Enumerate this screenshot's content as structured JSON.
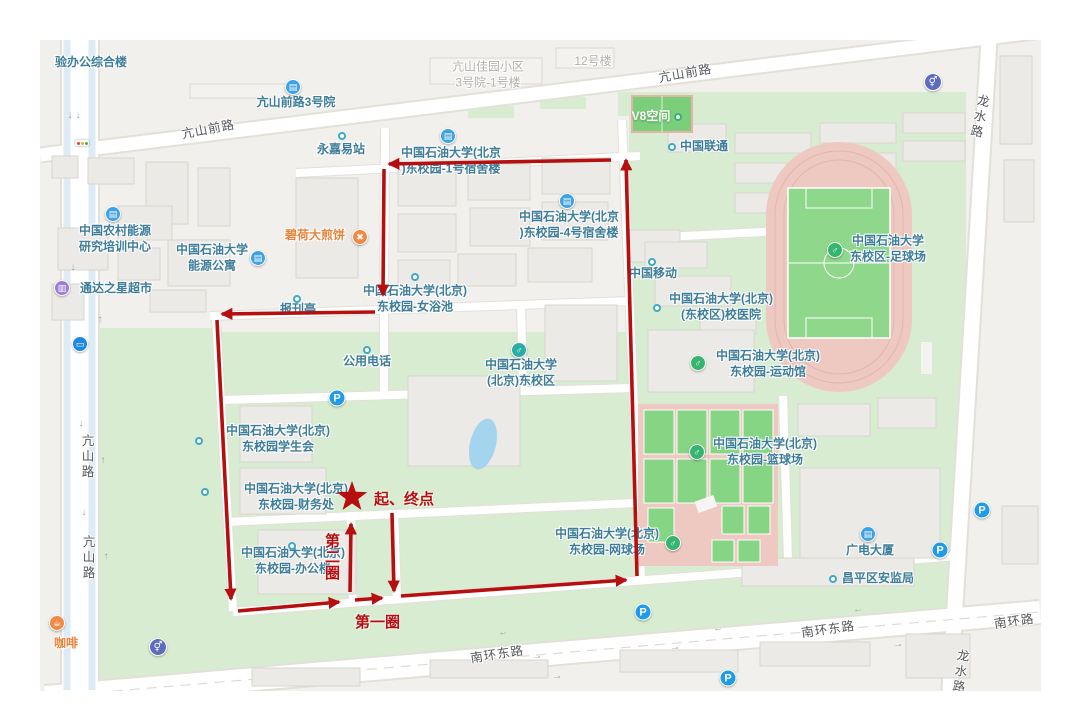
{
  "colors": {
    "map_bg": "#f1f0ed",
    "campus_green": "#d8ecd1",
    "track_pink": "#edc9c2",
    "pitch_green": "#8fd88b",
    "water_blue": "#a5d4ee",
    "poi_teal": "#3d7d99",
    "route_red": "#b60f0f"
  },
  "map": {
    "icons": {
      "building": "▤",
      "sport": "♂",
      "univ": "♂",
      "shop": "▥",
      "restaurant": "✖",
      "coffee": "☕",
      "parking": "P",
      "restroom": "⚥",
      "bus": "▭",
      "dot": "",
      "greendot": ""
    },
    "pois": [
      {
        "text": "验办公综合楼",
        "x": 91,
        "y": 63,
        "cls": "teal"
      },
      {
        "text": "亢山前路3号院",
        "x": 296,
        "y": 103,
        "cls": "teal",
        "icon": "building",
        "ix": 293,
        "iy": 87
      },
      {
        "text": "亢山佳园小区\n3号院-1号楼",
        "x": 488,
        "y": 75,
        "cls": "gray"
      },
      {
        "text": "12号楼",
        "x": 593,
        "y": 62,
        "cls": "gray"
      },
      {
        "text": "永嘉易站",
        "x": 341,
        "y": 150,
        "cls": "teal",
        "icon": "dot",
        "ix": 342,
        "iy": 136
      },
      {
        "text": "中国石油大学(北京\n)东校园-1号宿舍楼",
        "x": 451,
        "y": 161,
        "cls": "teal",
        "icon": "building",
        "ix": 448,
        "iy": 136
      },
      {
        "text": "V8空间",
        "x": 651,
        "y": 117,
        "cls": "white",
        "icon": "greendot",
        "ix": 678,
        "iy": 117
      },
      {
        "text": "中国联通",
        "x": 704,
        "y": 147,
        "cls": "teal",
        "icon": "dot",
        "ix": 672,
        "iy": 147
      },
      {
        "text": "碧荷大煎饼",
        "x": 315,
        "y": 236,
        "cls": "orange",
        "icon": "restaurant",
        "ix": 360,
        "iy": 237
      },
      {
        "text": "中国石油大学(北京\n)东校园-4号宿舍楼",
        "x": 569,
        "y": 225,
        "cls": "teal",
        "icon": "building",
        "ix": 567,
        "iy": 201
      },
      {
        "text": "中国农村能源\n研究培训中心",
        "x": 115,
        "y": 239,
        "cls": "teal",
        "icon": "building",
        "ix": 113,
        "iy": 214
      },
      {
        "text": "中国石油大学\n能源公寓",
        "x": 212,
        "y": 258,
        "cls": "teal",
        "icon": "building",
        "ix": 258,
        "iy": 258
      },
      {
        "text": "通达之星超市",
        "x": 116,
        "y": 289,
        "cls": "teal",
        "icon": "shop",
        "ix": 62,
        "iy": 288
      },
      {
        "text": "报刊亭",
        "x": 298,
        "y": 310,
        "cls": "teal",
        "icon": "dot",
        "ix": 297,
        "iy": 299
      },
      {
        "text": "中国石油大学(北京)\n东校园-女浴池",
        "x": 415,
        "y": 299,
        "cls": "teal",
        "icon": "dot",
        "ix": 415,
        "iy": 277
      },
      {
        "text": "中国移动",
        "x": 653,
        "y": 274,
        "cls": "teal",
        "icon": "dot",
        "ix": 652,
        "iy": 262
      },
      {
        "text": "中国石油大学(北京)\n(东校区)校医院",
        "x": 721,
        "y": 307,
        "cls": "teal",
        "icon": "dot",
        "ix": 657,
        "iy": 308
      },
      {
        "text": "中国石油大学\n东校区-足球场",
        "x": 888,
        "y": 249,
        "cls": "teal",
        "icon": "sport",
        "ix": 835,
        "iy": 250
      },
      {
        "text": "中国石油大学(北京)\n东校园-运动馆",
        "x": 768,
        "y": 364,
        "cls": "teal",
        "icon": "sport",
        "ix": 698,
        "iy": 363
      },
      {
        "text": "公用电话",
        "x": 367,
        "y": 362,
        "cls": "teal",
        "icon": "dot",
        "ix": 367,
        "iy": 350
      },
      {
        "text": "中国石油大学\n(北京)东校区",
        "x": 521,
        "y": 373,
        "cls": "teal",
        "icon": "univ",
        "ix": 519,
        "iy": 350
      },
      {
        "text": "中国石油大学(北京)\n东校园学生会",
        "x": 278,
        "y": 439,
        "cls": "teal",
        "icon": "dot",
        "ix": 199,
        "iy": 441
      },
      {
        "text": "中国石油大学(北京)\n东校园-财务处",
        "x": 296,
        "y": 497,
        "cls": "teal",
        "icon": "dot",
        "ix": 205,
        "iy": 492
      },
      {
        "text": "中国石油大学(北京)\n东校园-篮球场",
        "x": 765,
        "y": 452,
        "cls": "teal",
        "icon": "sport",
        "ix": 697,
        "iy": 452
      },
      {
        "text": "中国石油大学(北京)\n东校园-网球场",
        "x": 607,
        "y": 542,
        "cls": "teal",
        "icon": "sport",
        "ix": 673,
        "iy": 543
      },
      {
        "text": "中国石油大学(北京)\n东校园-办公楼",
        "x": 293,
        "y": 561,
        "cls": "teal",
        "icon": "dot",
        "ix": 292,
        "iy": 546
      },
      {
        "text": "广电大厦",
        "x": 870,
        "y": 551,
        "cls": "teal",
        "icon": "building",
        "ix": 868,
        "iy": 534
      },
      {
        "text": "昌平区安监局",
        "x": 878,
        "y": 579,
        "cls": "teal",
        "icon": "dot",
        "ix": 833,
        "iy": 579
      },
      {
        "text": "咖啡",
        "x": 66,
        "y": 644,
        "cls": "orange",
        "icon": "coffee",
        "ix": 57,
        "iy": 623
      }
    ],
    "road_labels": [
      {
        "text": "亢山前路",
        "x": 208,
        "y": 128,
        "rot": -11,
        "vert": false
      },
      {
        "text": "亢山前路",
        "x": 685,
        "y": 72,
        "rot": -10,
        "vert": false
      },
      {
        "text": "亢山路",
        "x": 87,
        "y": 457,
        "rot": 0,
        "vert": true
      },
      {
        "text": "亢山路",
        "x": 88,
        "y": 558,
        "rot": 0,
        "vert": true
      },
      {
        "text": "龙水路",
        "x": 979,
        "y": 117,
        "rot": 12,
        "vert": true
      },
      {
        "text": "龙水路",
        "x": 960,
        "y": 672,
        "rot": 8,
        "vert": true
      },
      {
        "text": "南环东路",
        "x": 497,
        "y": 653,
        "rot": -9,
        "vert": false
      },
      {
        "text": "南环东路",
        "x": 828,
        "y": 628,
        "rot": -8,
        "vert": false
      },
      {
        "text": "南环路",
        "x": 1014,
        "y": 620,
        "rot": -8,
        "vert": false
      }
    ],
    "markers": [
      {
        "type": "parking",
        "x": 337,
        "y": 398
      },
      {
        "type": "parking",
        "x": 643,
        "y": 612
      },
      {
        "type": "parking",
        "x": 728,
        "y": 678
      },
      {
        "type": "parking",
        "x": 940,
        "y": 550
      },
      {
        "type": "parking",
        "x": 982,
        "y": 510
      },
      {
        "type": "restroom",
        "x": 933,
        "y": 82
      },
      {
        "type": "restroom",
        "x": 158,
        "y": 647
      },
      {
        "type": "bus",
        "x": 80,
        "y": 344
      }
    ],
    "lane_arrows": [
      {
        "t": "←",
        "x": 503,
        "y": 633,
        "r": -8
      },
      {
        "t": "←",
        "x": 718,
        "y": 629,
        "r": -8
      },
      {
        "t": "←",
        "x": 858,
        "y": 610,
        "r": -8
      },
      {
        "t": "←",
        "x": 1012,
        "y": 617,
        "r": -8
      },
      {
        "t": "→",
        "x": 537,
        "y": 657,
        "r": -8
      },
      {
        "t": "→",
        "x": 675,
        "y": 648,
        "r": -8
      },
      {
        "t": "→",
        "x": 898,
        "y": 645,
        "r": -8
      },
      {
        "t": "→",
        "x": 557,
        "y": 677,
        "r": -8
      },
      {
        "t": "↓",
        "x": 70,
        "y": 116,
        "r": 0
      },
      {
        "t": "↓",
        "x": 78,
        "y": 116,
        "r": 0
      },
      {
        "t": "↓",
        "x": 81,
        "y": 424,
        "r": 0
      },
      {
        "t": "↑",
        "x": 103,
        "y": 461,
        "r": 0
      },
      {
        "t": "↓",
        "x": 84,
        "y": 513,
        "r": 0
      },
      {
        "t": "↑",
        "x": 106,
        "y": 557,
        "r": 0
      },
      {
        "t": "↓",
        "x": 73,
        "y": 268,
        "r": 0
      },
      {
        "t": "↑",
        "x": 100,
        "y": 320,
        "r": 0
      }
    ]
  },
  "route": {
    "color": "#b60f0f",
    "star": {
      "x": 352,
      "y": 497
    },
    "segments": [
      {
        "x1": 392,
        "y1": 513,
        "x2": 394,
        "y2": 591
      },
      {
        "x1": 401,
        "y1": 596,
        "x2": 626,
        "y2": 580
      },
      {
        "x1": 637,
        "y1": 576,
        "x2": 626,
        "y2": 160
      },
      {
        "x1": 611,
        "y1": 160,
        "x2": 389,
        "y2": 164
      },
      {
        "x1": 384,
        "y1": 169,
        "x2": 383,
        "y2": 295
      },
      {
        "x1": 375,
        "y1": 312,
        "x2": 222,
        "y2": 314
      },
      {
        "x1": 217,
        "y1": 320,
        "x2": 231,
        "y2": 599
      },
      {
        "x1": 238,
        "y1": 611,
        "x2": 339,
        "y2": 602
      },
      {
        "x1": 355,
        "y1": 600,
        "x2": 382,
        "y2": 598
      },
      {
        "x1": 350,
        "y1": 592,
        "x2": 351,
        "y2": 524
      }
    ],
    "labels": {
      "start_end": "起、终点",
      "lap1": "第一圈",
      "lap2": "第二圈"
    }
  }
}
